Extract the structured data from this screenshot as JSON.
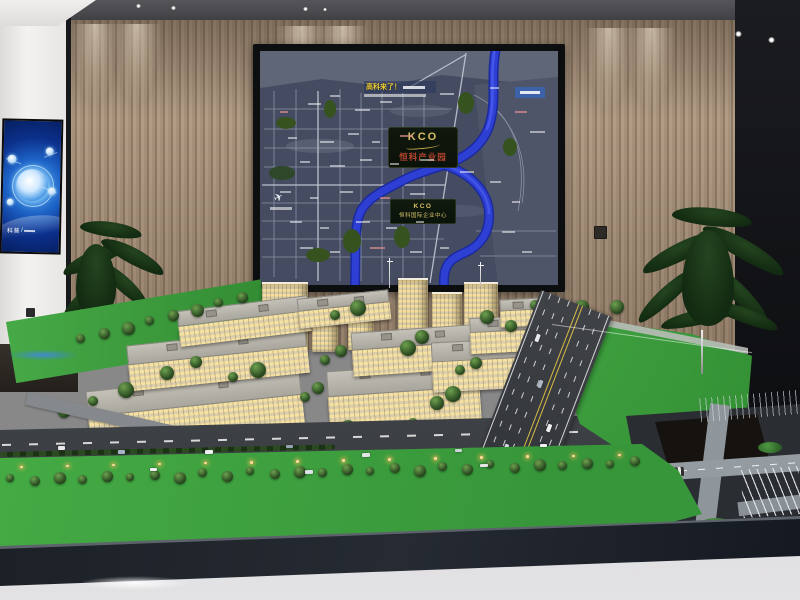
{
  "board": {
    "banner_headline": "高科来了！",
    "logo_primary_brand": "KCO",
    "logo_primary_name": "恒科产业园",
    "logo_secondary_brand": "KCO",
    "logo_secondary_name": "恒科国际企业中心"
  },
  "tv": {
    "caption": "科普"
  },
  "colors": {
    "river_blue": "#2e3fd4",
    "board_bg": "#454c61",
    "lawn_green": "#3aa23a",
    "wood_wall": "#a8937d",
    "building_cream": "#e9ddbd",
    "window_glow": "#f3d894",
    "screen_blue": "#1d62c6",
    "base_dark": "#1a1e24",
    "logo_gold": "#d8bd63",
    "logo_red": "#b5452f"
  }
}
